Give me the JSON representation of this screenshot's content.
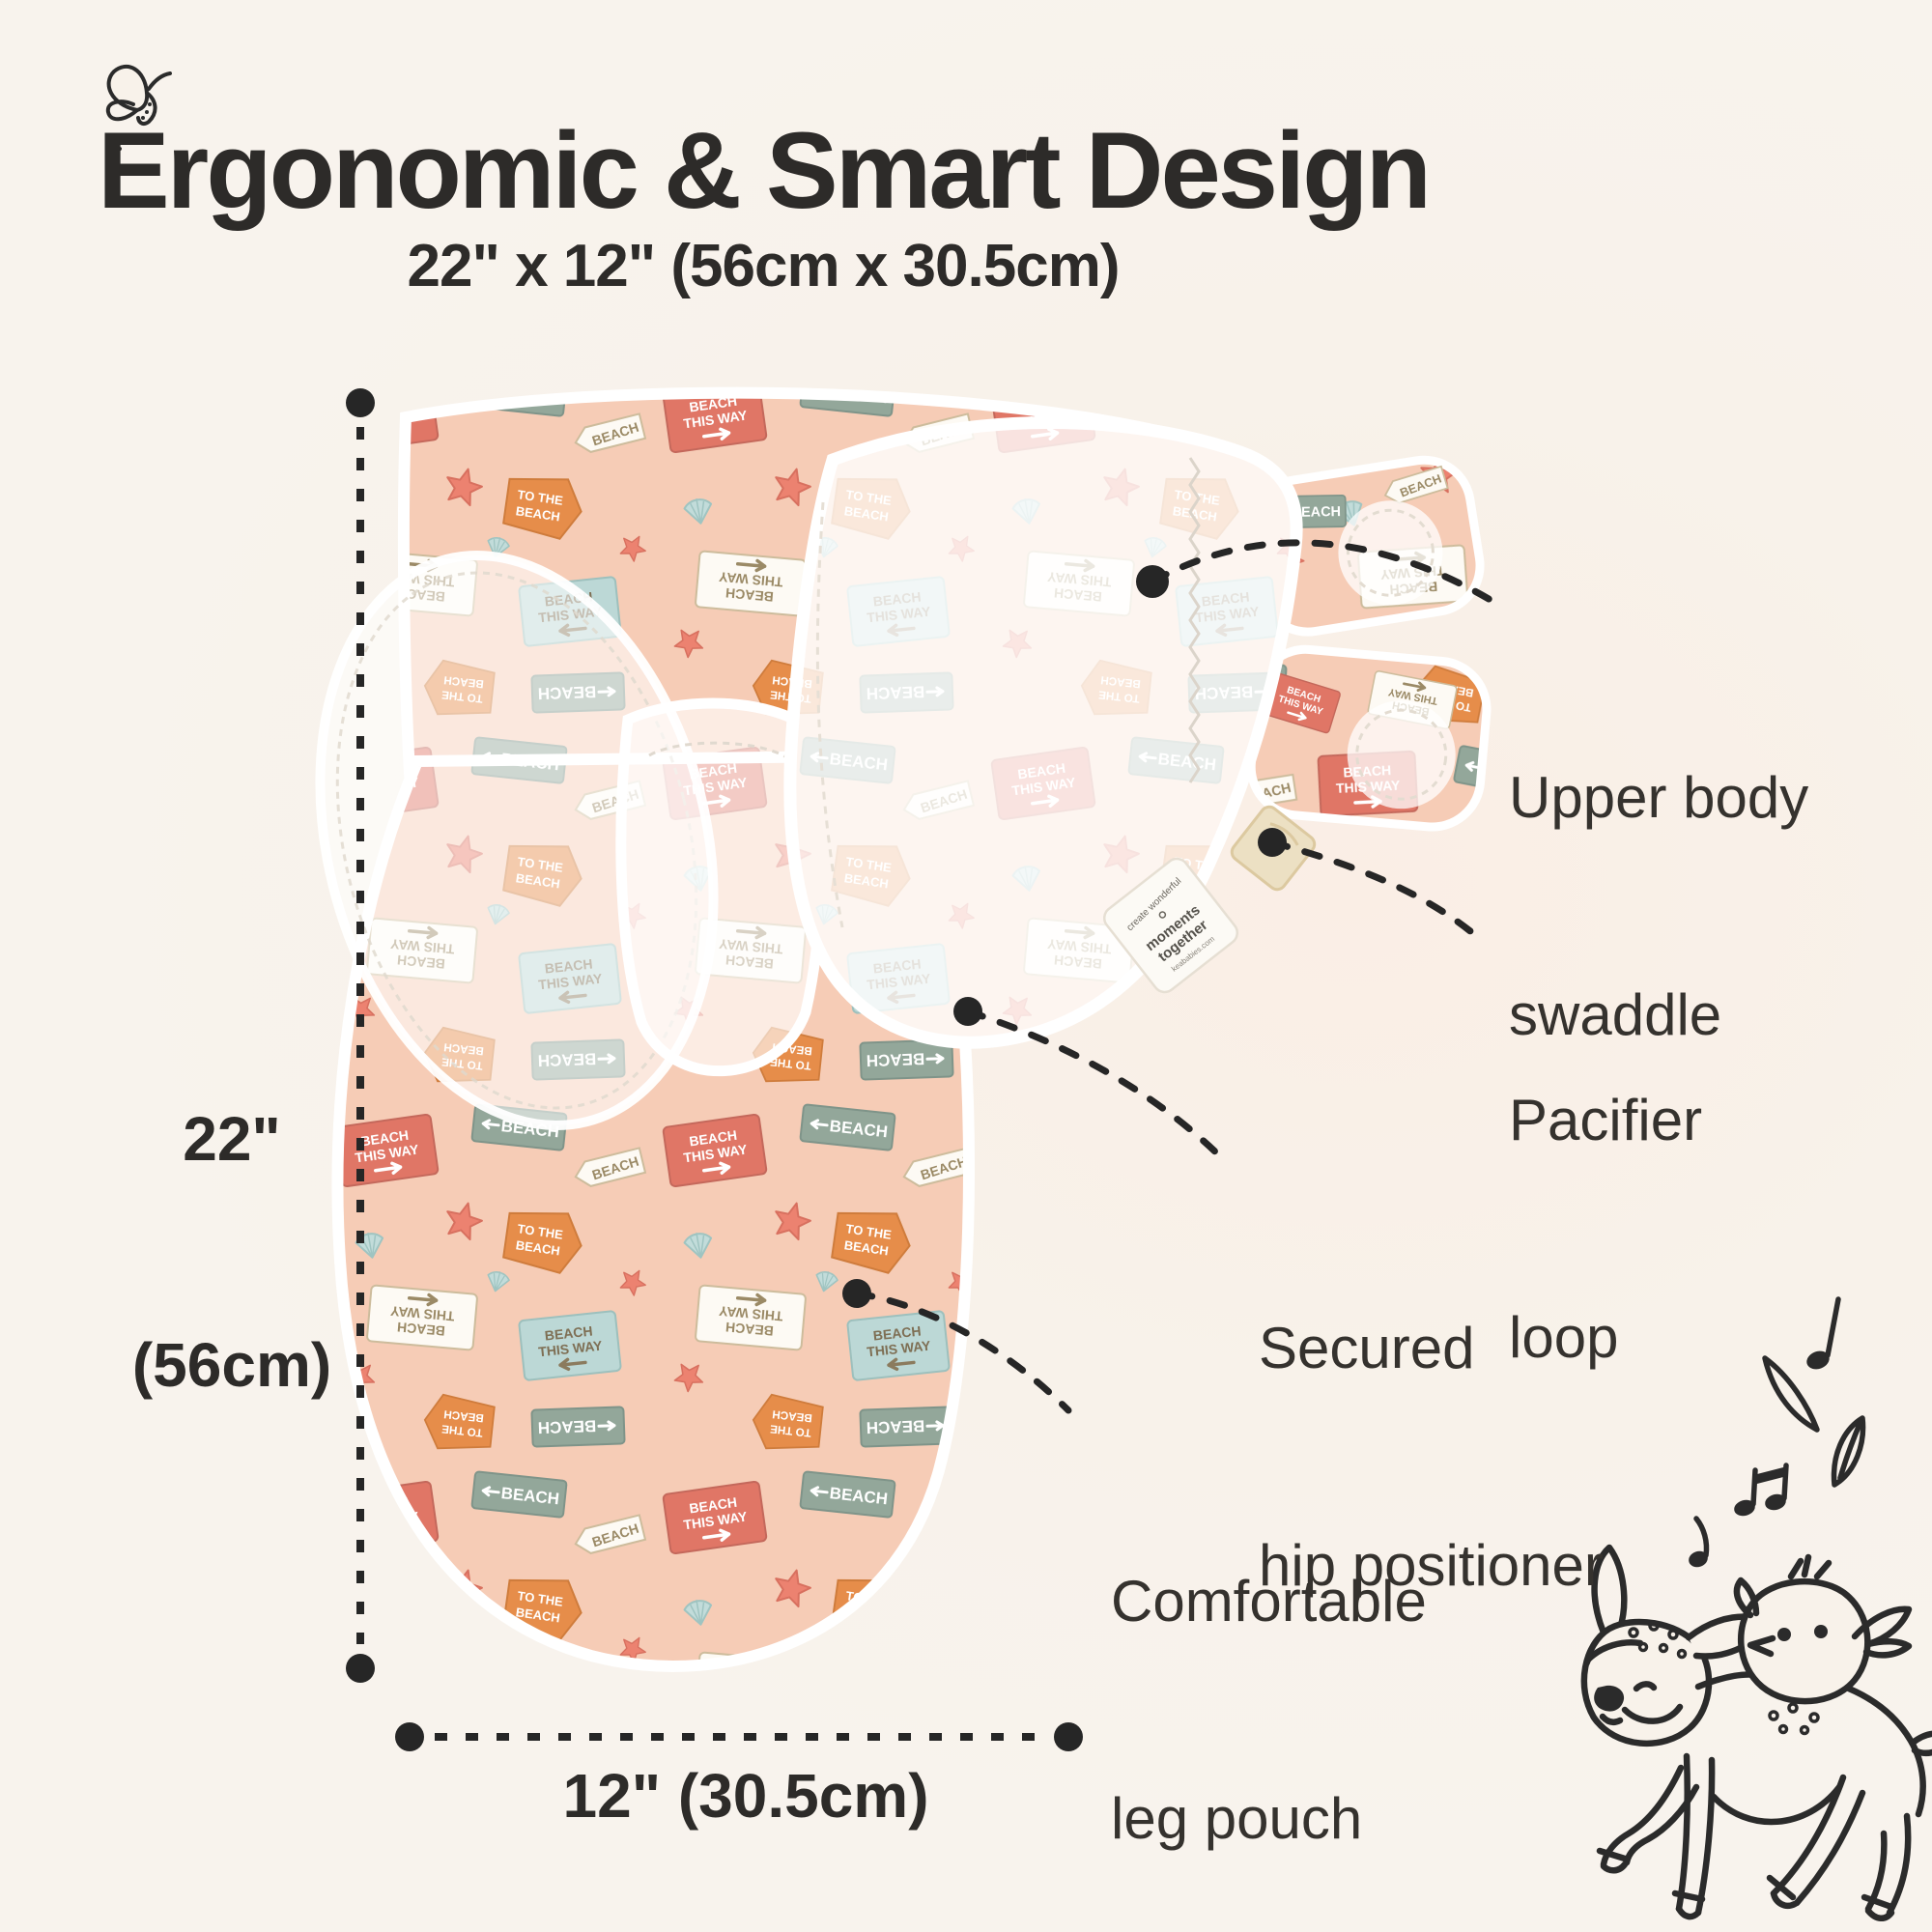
{
  "header": {
    "title": "Ergonomic & Smart Design",
    "subtitle": "22\" x 12\" (56cm x 30.5cm)"
  },
  "dimensions": {
    "height_line1": "22\"",
    "height_line2": "(56cm)",
    "width_label": "12\" (30.5cm)"
  },
  "callouts": {
    "upper_body": {
      "line1": "Upper body",
      "line2": "swaddle"
    },
    "pacifier": {
      "line1": "Pacifier",
      "line2": "loop"
    },
    "hip": {
      "line1": "Secured",
      "line2": "hip positioner"
    },
    "leg": {
      "line1": "Comfortable",
      "line2": "leg pouch"
    }
  },
  "swaddle_pattern": {
    "sign_line1": "BEACH",
    "sign_line2": "THIS WAY",
    "pennant_line1": "TO THE",
    "pennant_line2": "BEACH",
    "ticket_text": "BEACH",
    "tag_text": "BEACH"
  },
  "brand_tag": {
    "arc_text": "create wonderful",
    "line1": "moments",
    "line2": "together",
    "url": "keababies.com"
  },
  "colors": {
    "background": "#f8f2ea",
    "fabric_peach": "#f6ccb6",
    "coral": "#e07666",
    "orange": "#e68d4a",
    "sage": "#93a79a",
    "light_blue": "#bcd8d6",
    "loop_cream": "#ece0c3",
    "ink": "#2d2b29"
  },
  "icons": {
    "butterfly": "butterfly-doodle",
    "deer_bird": "deer-and-bird-doodle",
    "music": "music-notes-and-leaves"
  }
}
